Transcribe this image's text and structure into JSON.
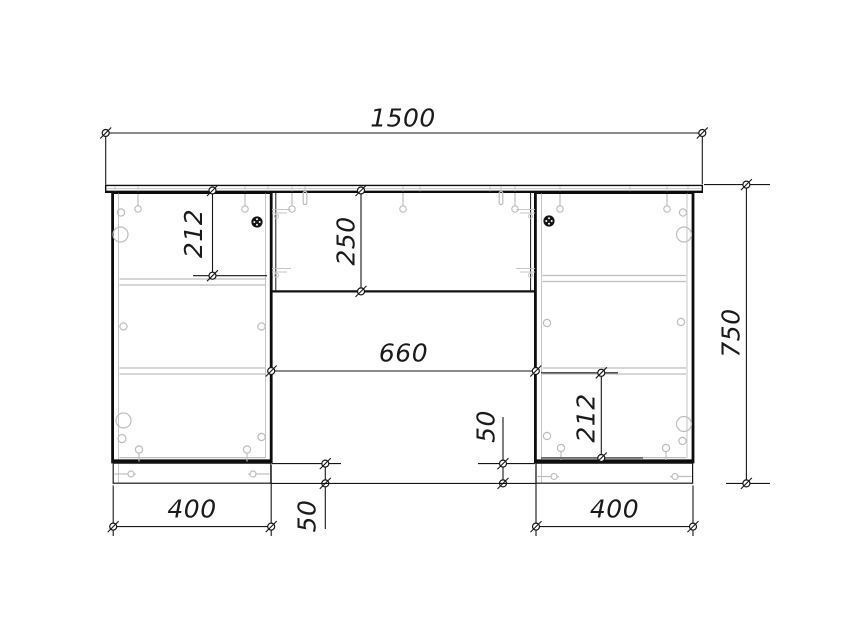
{
  "dims": {
    "overall_width": "1500",
    "overall_height": "750",
    "knee_space_width": "660",
    "top_panel_height": "250",
    "left_top_offset": "212",
    "right_bottom_offset": "212",
    "left_pedestal_width": "400",
    "right_pedestal_width": "400",
    "left_plinth_height": "50",
    "right_plinth_height": "50"
  },
  "colors": {
    "line": "#141414",
    "hardware": "#bdbdbd",
    "dimension_text": "#1a1a1a",
    "background": "#ffffff"
  },
  "symbols": {
    "dim_marker": "circle-with-slash-tick",
    "cam_lock": "filled-black-dot",
    "hinge": "concentric-circles",
    "screw": "pin-with-round-head",
    "shelf_pin": "small-circle",
    "plinth_screw": "horizontal-bolt",
    "dowel": "rounded-peg-outline"
  }
}
